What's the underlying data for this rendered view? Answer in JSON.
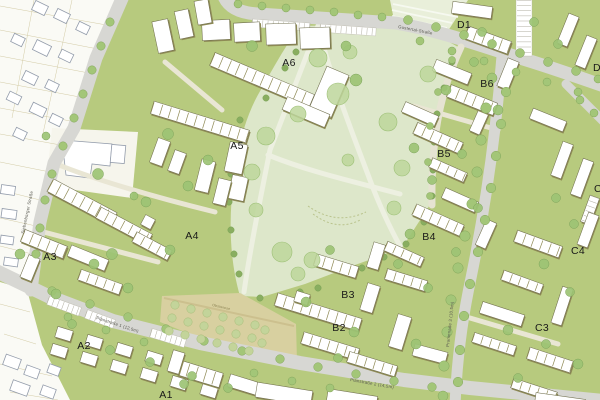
{
  "plan": {
    "districts": [
      {
        "label": "A1"
      },
      {
        "label": "A2"
      },
      {
        "label": "A3"
      },
      {
        "label": "A4"
      },
      {
        "label": "A5"
      },
      {
        "label": "A6"
      },
      {
        "label": "B2"
      },
      {
        "label": "B3"
      },
      {
        "label": "B4"
      },
      {
        "label": "B5"
      },
      {
        "label": "B6"
      },
      {
        "label": "C3"
      },
      {
        "label": "C4"
      },
      {
        "label": "C5"
      },
      {
        "label": "D1"
      },
      {
        "label": "D2"
      }
    ],
    "streets": [
      {
        "name": "Planstraße 1 (12,5m)"
      },
      {
        "name": "Planstraße 2 (14,5m)"
      },
      {
        "name": "Promenade 3 (10,5m)"
      },
      {
        "name": "Gustertal-Straße"
      },
      {
        "name": "Siebenbürger Straße"
      },
      {
        "name": "Obstwiese"
      }
    ],
    "colors": {
      "block_green": "#b7ca7e",
      "park_green": "#dde7ca",
      "path_light": "#edf0e1",
      "road_gray": "#d7d7d3",
      "orchard_tan": "#d8d0a0",
      "building_white": "#ffffff",
      "building_shadow": "#8e8a55",
      "existing_bg": "#fafaf5",
      "existing_outline": "#939cab",
      "tree_green": "#a3c678",
      "label_black": "#191919",
      "field_green": "#e9efda"
    }
  }
}
